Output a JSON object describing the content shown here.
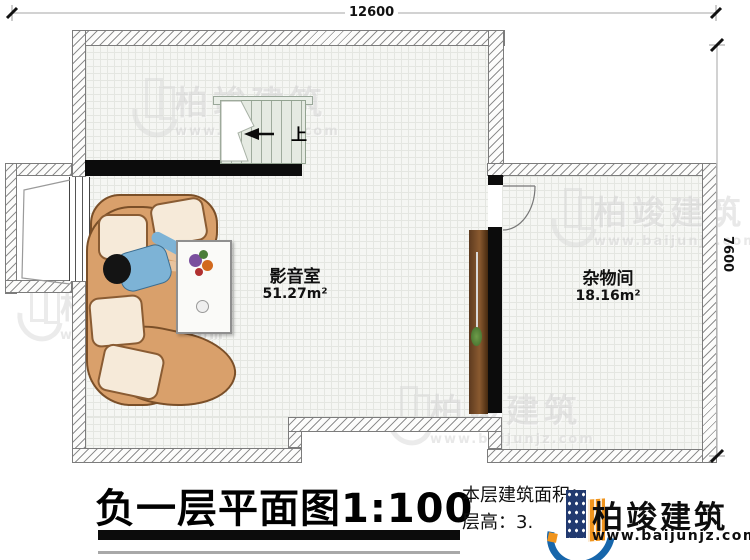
{
  "dimensions": {
    "top": "12600",
    "right": "7600"
  },
  "stairs": {
    "up_label": "上"
  },
  "rooms": [
    {
      "name": "影音室",
      "area": "51.27m²"
    },
    {
      "name": "杂物间",
      "area": "18.16m²"
    }
  ],
  "title": {
    "text": "负一层平面图",
    "scale": "1:100"
  },
  "info": {
    "area_label": "本层建筑面积：",
    "height_label": "层高：3."
  },
  "logo": {
    "name": "柏竣建筑",
    "url": "www.baijunjz.com"
  },
  "watermark": {
    "text": "柏竣建筑",
    "url": "www.baijunjz.com"
  },
  "colors": {
    "accent_blue": "#1766ab",
    "accent_orange": "#f0941d",
    "wall_fill": "#0c0c0c",
    "sofa_tan": "#d9a06b"
  }
}
